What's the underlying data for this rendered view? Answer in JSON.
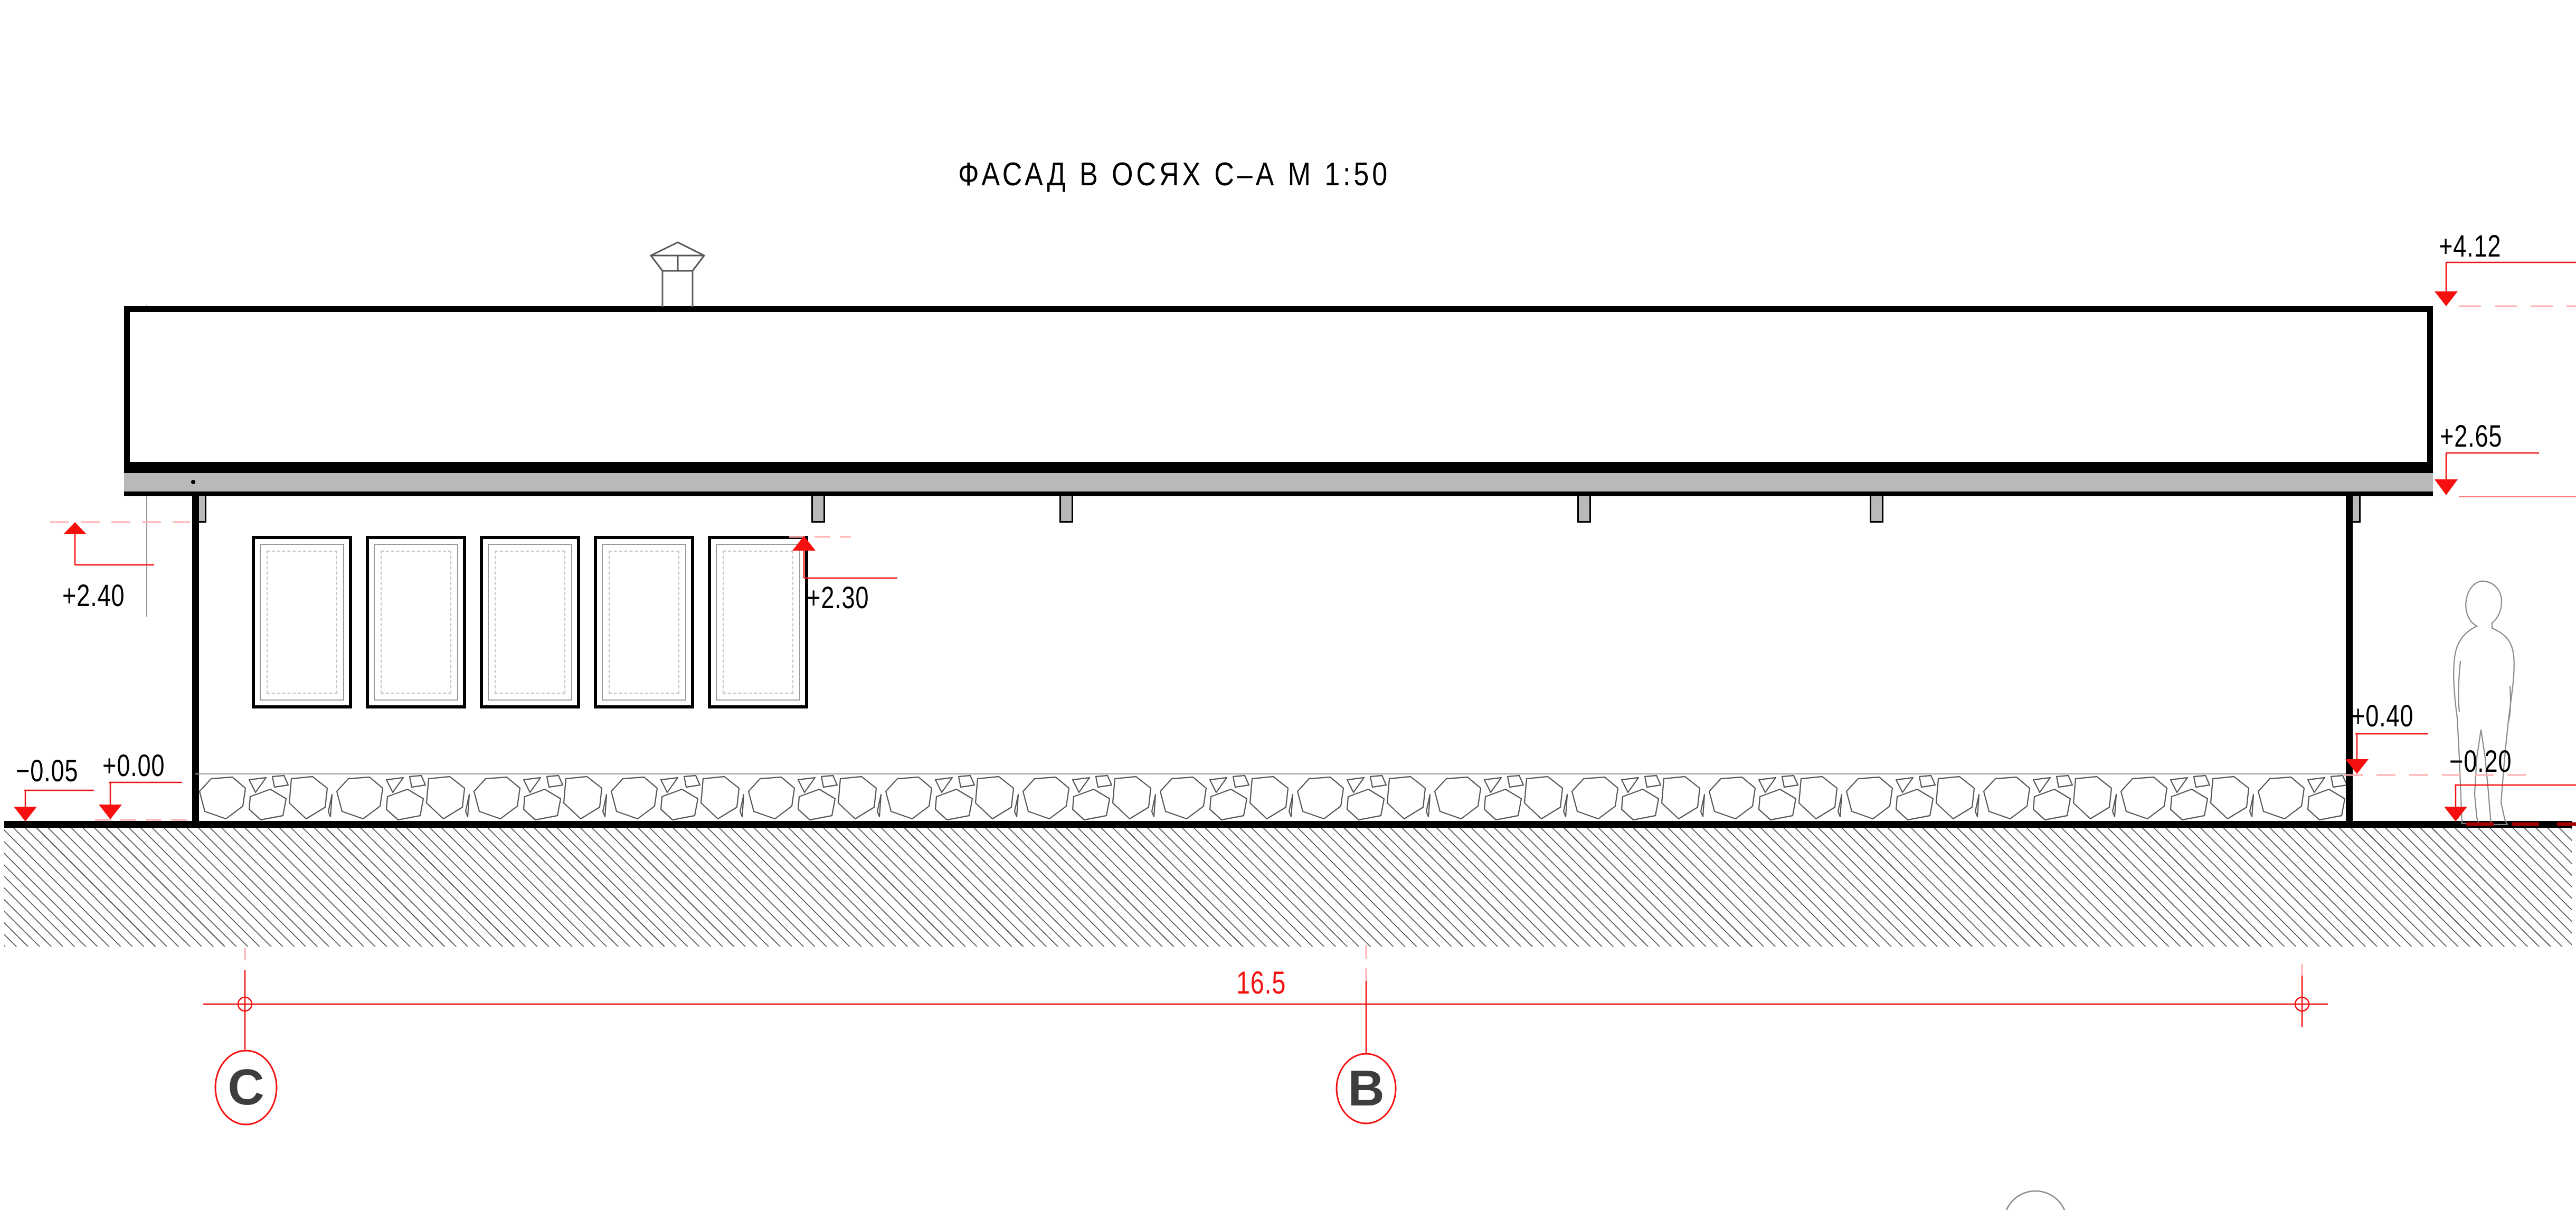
{
  "drawing": {
    "title": "ФАСАД В ОСЯХ С–А М 1:50",
    "dimension_total": "16.5",
    "axes": {
      "left": "C",
      "middle": "B"
    },
    "elevations": {
      "roof_top": "+4.12",
      "eave_bottom": "+2.65",
      "canopy_underside": "+2.40",
      "window_head": "+2.30",
      "plinth_top": "+0.40",
      "floor_level": "+0.00",
      "ground_left": "−0.05",
      "ground_right": "−0.20"
    },
    "colors": {
      "marker_red": "#f50f0f",
      "eave_gray": "#b9b9b9",
      "line_black": "#000000",
      "stone_outline": "#555555"
    }
  }
}
